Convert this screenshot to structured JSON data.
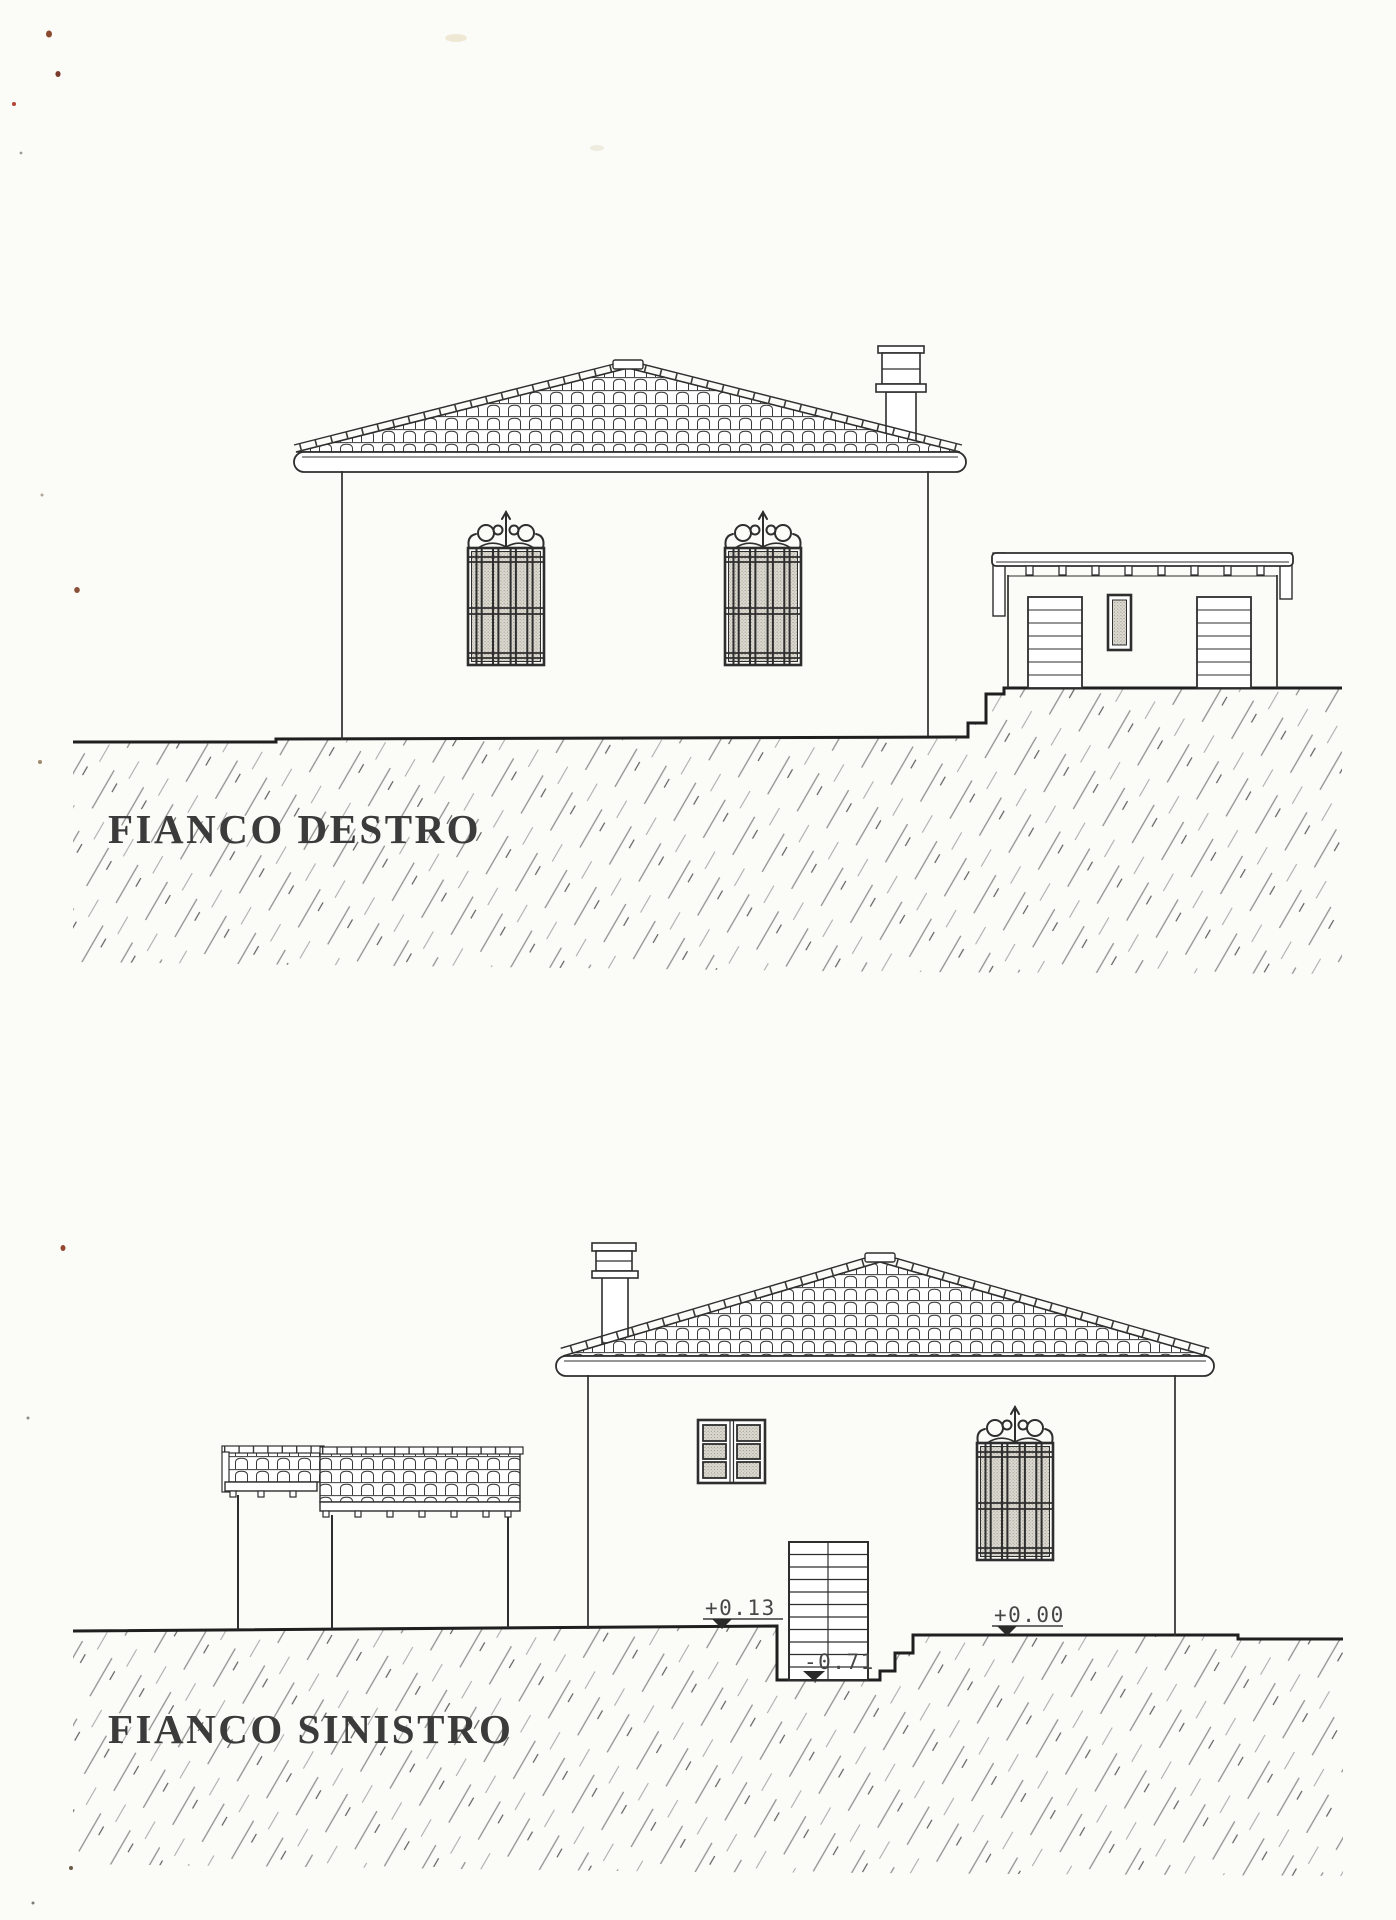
{
  "sheet": {
    "type": "scanned architectural elevation drawing",
    "paper_color": "#fbfbf8",
    "ink_color": "#2e2e2e",
    "hatch_color": "#8f8f8f",
    "glass_shade_color": "#dedbd2"
  },
  "top_drawing": {
    "title": "FIANCO DESTRO"
  },
  "bottom_drawing": {
    "title": "FIANCO SINISTRO",
    "level_markers": {
      "upper_ground": "+0.13",
      "lower_ground": "+0.00",
      "stair_pit": "-0.71"
    }
  }
}
